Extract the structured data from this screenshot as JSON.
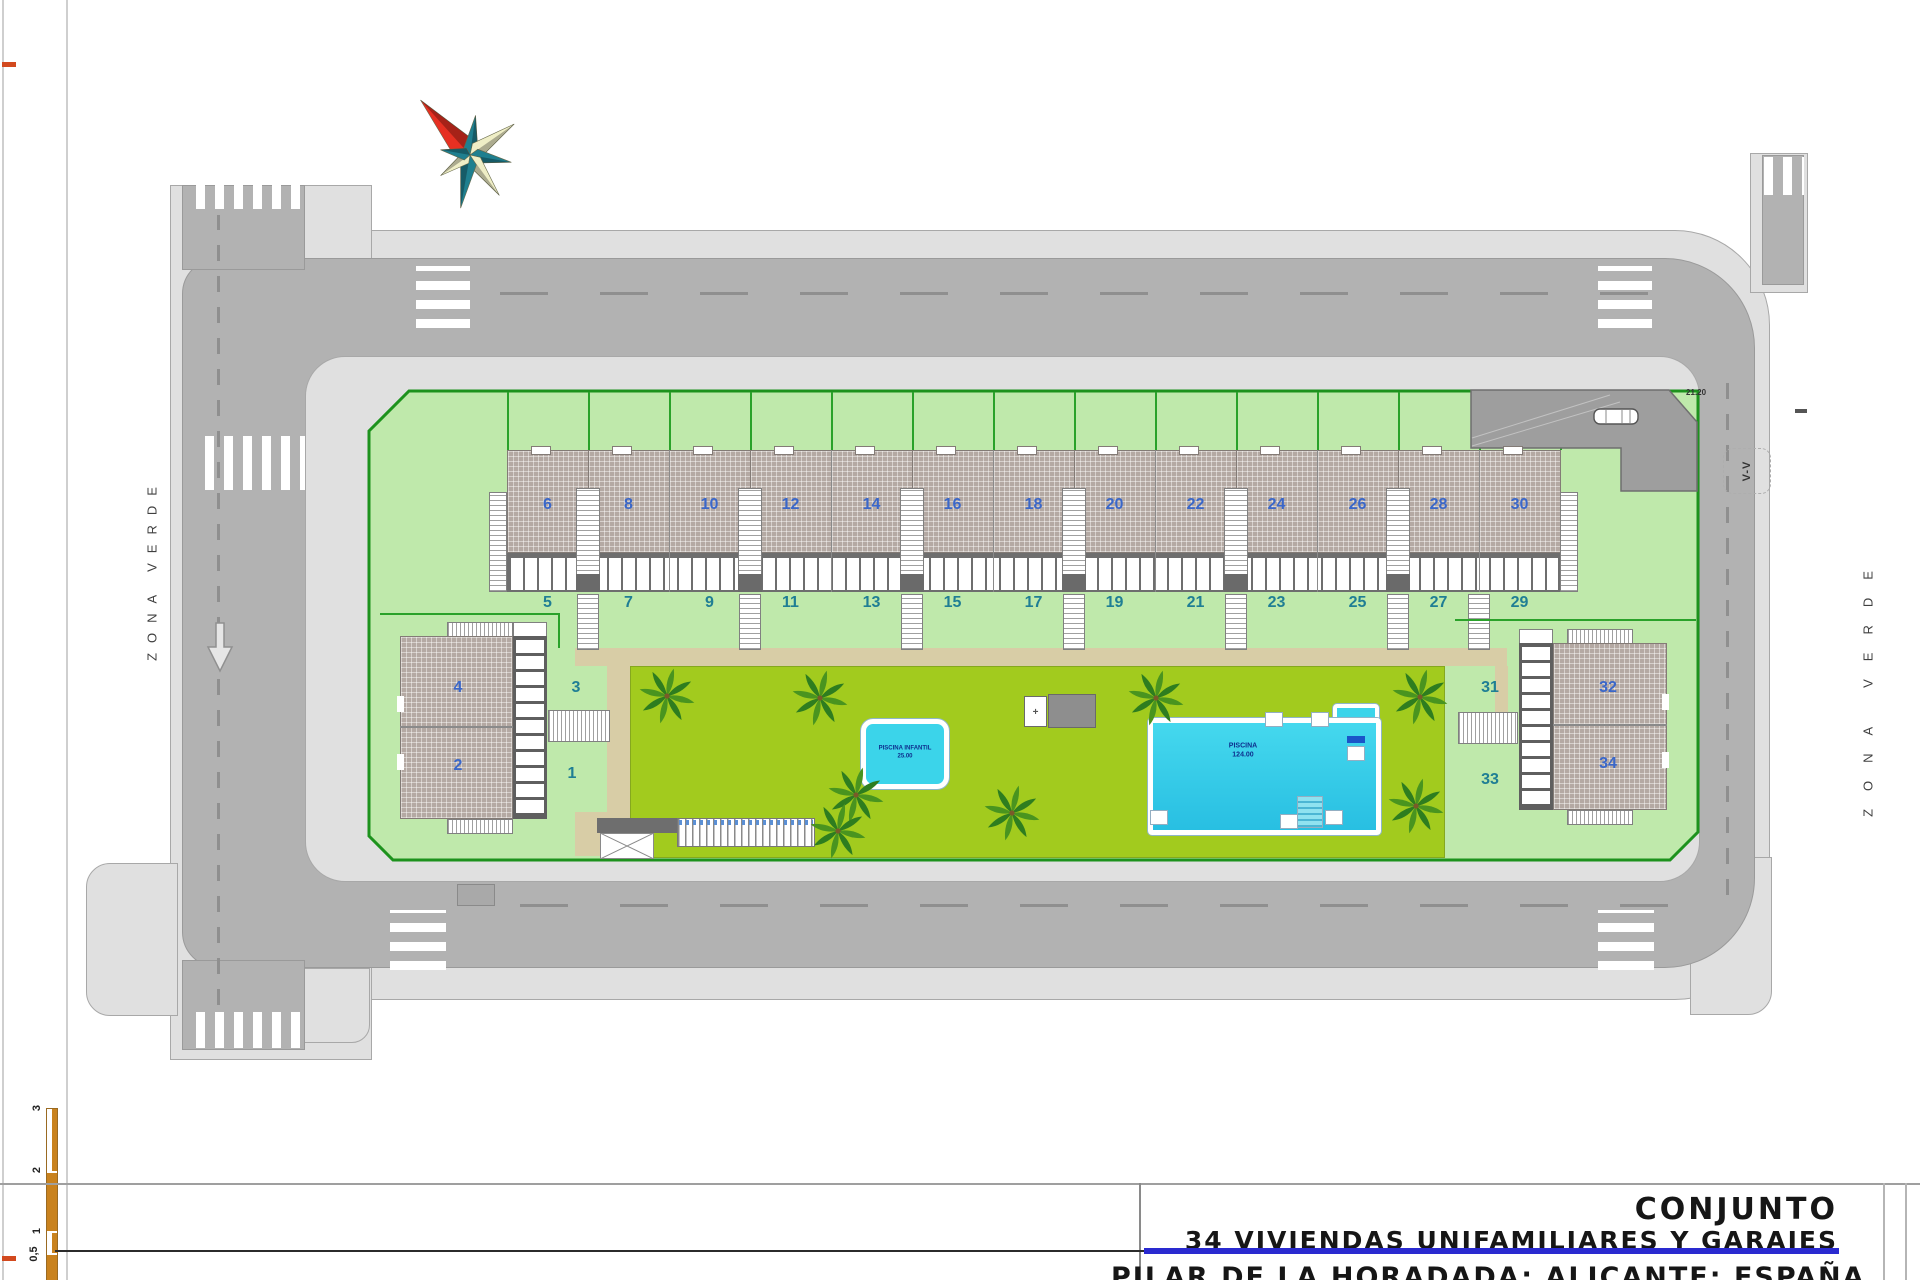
{
  "title_block": {
    "line1": "CONJUNTO",
    "line2": "34 VIVIENDAS UNIFAMILIARES Y GARAJES",
    "line3": "PILAR DE LA HORADADA; ALICANTE; ESPAÑA"
  },
  "labels": {
    "zona_verde_left": "ZONA VERDE",
    "zona_verde_right": "ZONA VERDE",
    "section_marker": "V-V",
    "driveway_dim": "21.20"
  },
  "pools": {
    "kids": {
      "name": "PISCINA INFANTIL",
      "area": "25.00"
    },
    "main": {
      "name": "PISCINA",
      "area": "124.00"
    }
  },
  "units": {
    "row_upper": [
      "6",
      "8",
      "10",
      "12",
      "14",
      "16",
      "18",
      "20",
      "22",
      "24",
      "26",
      "28",
      "30"
    ],
    "row_lower": [
      "5",
      "7",
      "9",
      "11",
      "13",
      "15",
      "17",
      "19",
      "21",
      "23",
      "25",
      "27",
      "29"
    ],
    "west": {
      "upper": "4",
      "lower": "2",
      "plot_upper": "3",
      "plot_lower": "1"
    },
    "east": {
      "upper": "32",
      "lower": "34",
      "plot_upper": "31",
      "plot_lower": "33"
    }
  },
  "scale_bar": {
    "labels": [
      "3",
      "2",
      "1",
      "0,5"
    ]
  },
  "colors": {
    "road": "#b2b2b2",
    "sidewalk": "#e0e0e0",
    "parcel": "#bfe9ab",
    "parcel_border": "#1d921d",
    "garden": "#a2cb1e",
    "path_tan": "#d8cda6",
    "roof": "#b4a9a3",
    "pool_water": "#3bd4ea",
    "accent_blue": "#2a2ad0",
    "unit_even": "#3a67c9",
    "unit_odd": "#1f7e94",
    "compass_red": "#e63022",
    "compass_teal": "#1f7f8f",
    "compass_cream": "#efeec6",
    "scale_orange": "#c9821e"
  }
}
